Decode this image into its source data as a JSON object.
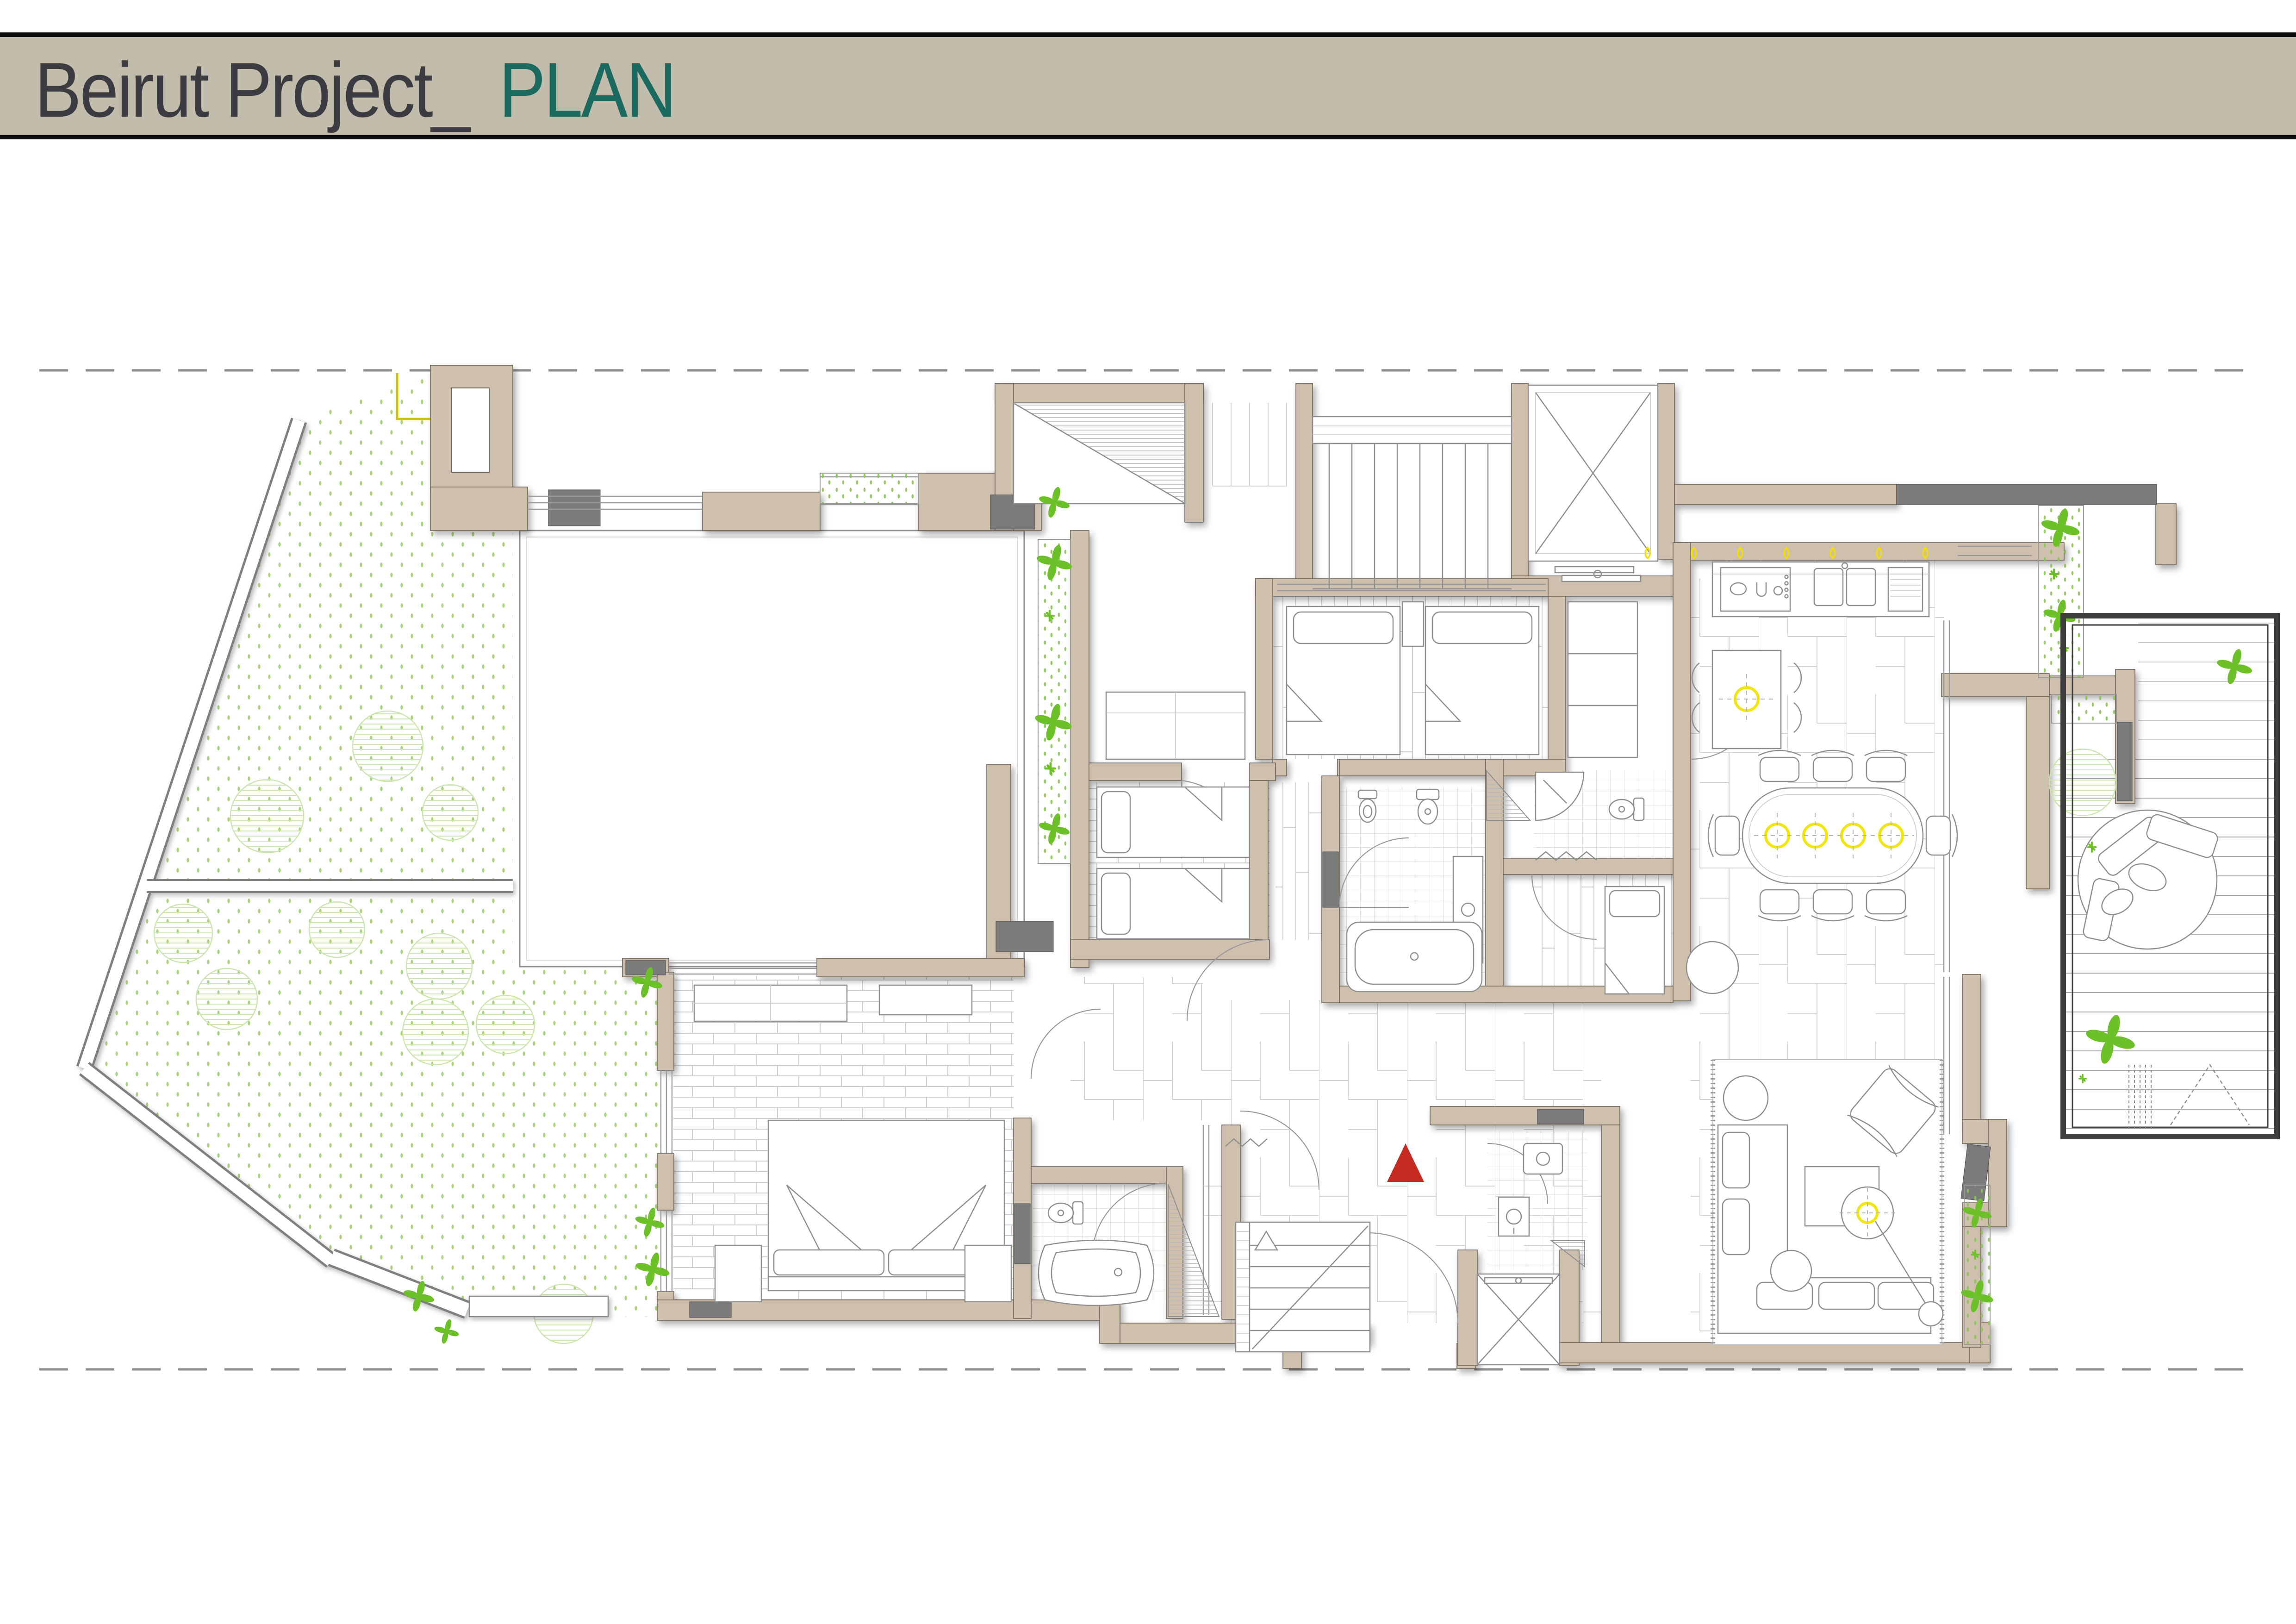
{
  "header": {
    "title_prefix": "Beirut Project_",
    "title_accent": "PLAN"
  },
  "colors": {
    "paper": "#ffffff",
    "header_bg": "#c1bcab",
    "header_line": "#0d0d0d",
    "title_text": "#3c3b41",
    "title_accent": "#1a6a5f",
    "wall": "#cfc0ad",
    "wall_outline": "#6b6155",
    "wall_gray": "#7b7b7b",
    "frame": "#3e3e3e",
    "line": "#8f8f8f",
    "line_light": "#c9c9c9",
    "floor_line": "#d4d4d4",
    "plant": "#6cc028",
    "plant_light": "#a8d77d",
    "shrub": "#cde5b0",
    "garden_dot": "#9ccc66",
    "light": "#f2e50a",
    "flame": "#f2de00",
    "accent_red": "#c62b21",
    "boundary": "#8c8c8c",
    "marker_yellow": "#cfc400"
  },
  "plan": {
    "boundary_lines": 2,
    "entry_marker": "red-triangle",
    "lights": {
      "kitchen_flames": 7,
      "dining_rings": 4,
      "breakfast_rings": 1,
      "living_rings": 1
    },
    "elevators": 2,
    "stairs": 2,
    "beds": {
      "twin_room": 2,
      "second_bedroom": 2,
      "master": 1,
      "maid": 1
    },
    "garden_shrubs": 10,
    "planters": 5
  }
}
